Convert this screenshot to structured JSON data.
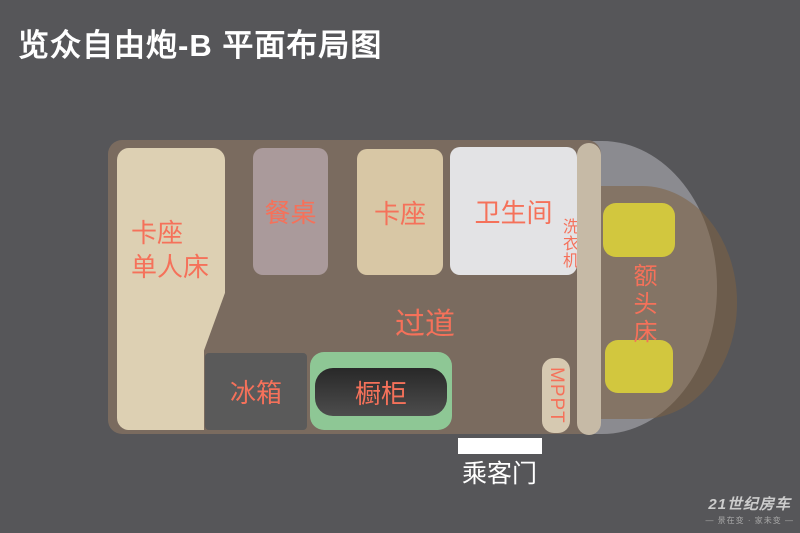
{
  "title": "览众自由炮-B 平面布局图",
  "plan": {
    "bed": {
      "line1": "卡座",
      "line2": "单人床"
    },
    "table": {
      "label": "餐桌"
    },
    "booth": {
      "label": "卡座"
    },
    "bathroom": {
      "label": "卫生间"
    },
    "washer": {
      "label": "洗衣机"
    },
    "aisle": {
      "label": "过道"
    },
    "fridge": {
      "label": "冰箱"
    },
    "cabinet": {
      "label": "橱柜"
    },
    "mppt": {
      "label": "MPPT"
    },
    "overhead_bed": {
      "label": "额头床"
    },
    "door": {
      "label": "乘客门"
    }
  },
  "brand": {
    "name": "21世纪房车",
    "slogan": "— 景在变 · 家未变 —"
  },
  "colors": {
    "background": "#565659",
    "body": "#7a6b5f",
    "accent_text": "#f5715a",
    "bed": "#ddd0b3",
    "table": "#aa9a9b",
    "booth": "#d8c7a5",
    "bathroom": "#e3e3e5",
    "fridge": "#5a5a5a",
    "cabinet_outer": "#8ec795",
    "cabinet_inner": "#383838",
    "mppt": "#d6c9b1",
    "pillar": "#c6baa6",
    "cab": "#8b8b90",
    "cab_overlay": "rgba(128,98,66,0.55)",
    "seat_yellow": "#d2c73e",
    "door": "#ffffff"
  }
}
